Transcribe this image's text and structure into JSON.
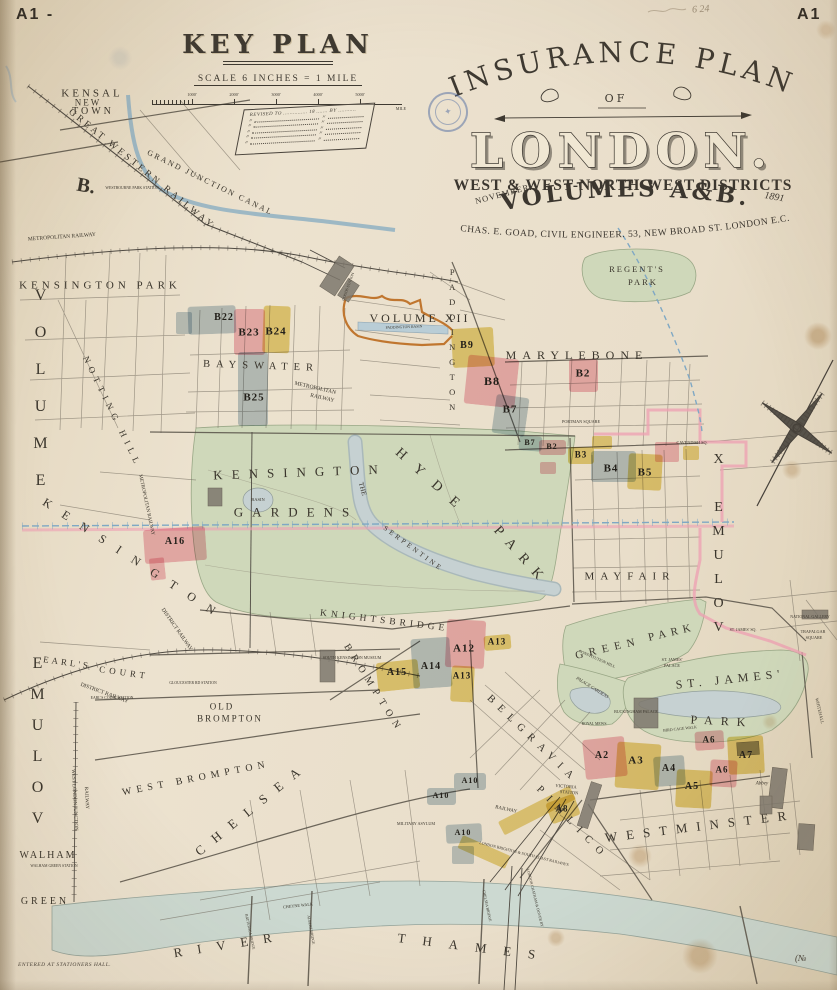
{
  "page": {
    "corner_left": "A1 -",
    "corner_right": "A1",
    "pencil_note": "6 24"
  },
  "key_plan": {
    "title": "KEY PLAN",
    "scale_label": "SCALE  6 INCHES = 1 MILE",
    "scale_ticks": [
      "1000'",
      "2000'",
      "3000'",
      "4000'",
      "5000'"
    ],
    "scale_end": "MILE",
    "revised_header": "REVISED TO ............... 18 ....... BY ...........",
    "revised_rows": [
      "〃",
      "〃",
      "〃",
      "〃",
      "〃"
    ]
  },
  "title_block": {
    "arc": "INSURANCE PLAN",
    "of": "OF",
    "city": "LONDON.",
    "districts": "WEST & WEST-NORTH-WEST DISTRICTS",
    "month": "NOVEMBER",
    "year": "1891",
    "volumes": "VOLUMES A&B.",
    "credit": "CHAS. E. GOAD, CIVIL ENGINEER. 53, NEW BROAD ST. LONDON E.C."
  },
  "footer": {
    "entered": "ENTERED AT STATIONERS HALL.",
    "number": "(№"
  },
  "map": {
    "palette": {
      "pink": "#f0b0bd",
      "yellow": "#e7d06e",
      "blue": "#b5c7d2"
    },
    "labels": [
      {
        "t": "KENSAL",
        "x": 92,
        "y": 94,
        "fs": 11,
        "ls": 3
      },
      {
        "t": "NEW",
        "x": 88,
        "y": 103,
        "fs": 9,
        "ls": 2
      },
      {
        "t": "TOWN",
        "x": 93,
        "y": 112,
        "fs": 10,
        "ls": 3
      },
      {
        "t": "GREAT WESTERN RAILWAY",
        "x": 141,
        "y": 170,
        "fs": 9.5,
        "ls": 3,
        "r": 39
      },
      {
        "t": "GRAND JUNCTION CANAL",
        "x": 210,
        "y": 183,
        "fs": 8,
        "ls": 2,
        "r": 26
      },
      {
        "t": "METROPOLITAN RAILWAY",
        "x": 62,
        "y": 238,
        "fs": 5.5,
        "r": -4
      },
      {
        "t": "WESTBOURNE PARK STATION",
        "x": 132,
        "y": 189,
        "fs": 3.8
      },
      {
        "t": "KENSINGTON PARK",
        "x": 100,
        "y": 286,
        "fs": 11,
        "ls": 4
      },
      {
        "t": "NOTTING HILL",
        "x": 112,
        "y": 412,
        "fs": 9,
        "ls": 5,
        "r": 64
      },
      {
        "t": "B.",
        "x": 86,
        "y": 186,
        "fs": 20,
        "r": 10,
        "b": true
      },
      {
        "t": "VOLUME",
        "x": 40,
        "y": 398,
        "fs": 16,
        "ls": 20,
        "v": true
      },
      {
        "t": "VOLUME",
        "x": 37,
        "y": 748,
        "fs": 16,
        "ls": 14,
        "v": true,
        "rev": true
      },
      {
        "t": "VOLUME X",
        "x": 718,
        "y": 548,
        "fs": 14,
        "ls": 9,
        "v": true,
        "rev": true
      },
      {
        "t": "BAYSWATER",
        "x": 261,
        "y": 367,
        "fs": 10.5,
        "ls": 6,
        "r": 2
      },
      {
        "t": "METROPOLITAN",
        "x": 315,
        "y": 389,
        "fs": 5.5,
        "r": 13
      },
      {
        "t": "RAILWAY",
        "x": 322,
        "y": 399,
        "fs": 5.5,
        "r": 13
      },
      {
        "t": "VOLUME XII",
        "x": 420,
        "y": 318,
        "fs": 12,
        "ls": 3
      },
      {
        "t": "PADDINGTON BASIN",
        "x": 404,
        "y": 328,
        "fs": 3.8,
        "r": -2
      },
      {
        "t": "GOODS STATION",
        "x": 349,
        "y": 287,
        "fs": 3.8,
        "r": -70
      },
      {
        "t": "PADDINGTON",
        "x": 452,
        "y": 342,
        "fs": 8.5,
        "ls": 5,
        "v": true
      },
      {
        "t": "MARYLEBONE",
        "x": 577,
        "y": 355,
        "fs": 12,
        "ls": 6
      },
      {
        "t": "PORTMAN SQUARE",
        "x": 581,
        "y": 422,
        "fs": 4.2
      },
      {
        "t": "CAVENDISH SQ.",
        "x": 692,
        "y": 443,
        "fs": 4.2
      },
      {
        "t": "REGENT'S",
        "x": 637,
        "y": 269,
        "fs": 8.5,
        "ls": 2
      },
      {
        "t": "PARK",
        "x": 643,
        "y": 282,
        "fs": 8.5,
        "ls": 2
      },
      {
        "t": "MAYFAIR",
        "x": 630,
        "y": 577,
        "fs": 11,
        "ls": 6
      },
      {
        "t": "KENSINGTON",
        "x": 300,
        "y": 472,
        "fs": 13,
        "ls": 9,
        "r": -2
      },
      {
        "t": "GARDENS",
        "x": 296,
        "y": 512,
        "fs": 13,
        "ls": 9
      },
      {
        "t": "HYDE",
        "x": 432,
        "y": 483,
        "fs": 14,
        "ls": 14,
        "r": 42
      },
      {
        "t": "PARK",
        "x": 521,
        "y": 557,
        "fs": 14,
        "ls": 10,
        "r": 48
      },
      {
        "t": "THE",
        "x": 362,
        "y": 489,
        "fs": 7,
        "r": 75
      },
      {
        "t": "SERPENTINE",
        "x": 413,
        "y": 549,
        "fs": 7,
        "ls": 3,
        "r": 36
      },
      {
        "t": "BASIN",
        "x": 258,
        "y": 500,
        "fs": 4.5
      },
      {
        "t": "KENSINGTON",
        "x": 135,
        "y": 560,
        "fs": 12,
        "ls": 14,
        "r": 33
      },
      {
        "t": "METROPOLITAN RAILWAY",
        "x": 146,
        "y": 505,
        "fs": 5,
        "r": 78
      },
      {
        "t": "KNIGHTSBRIDGE",
        "x": 384,
        "y": 622,
        "fs": 9.5,
        "ls": 4,
        "r": 7
      },
      {
        "t": "SOUTH KENSINGTON MUSEUM",
        "x": 352,
        "y": 658,
        "fs": 4
      },
      {
        "t": "BROMPTON",
        "x": 373,
        "y": 689,
        "fs": 10,
        "ls": 6,
        "r": 58
      },
      {
        "t": "OLD",
        "x": 222,
        "y": 707,
        "fs": 9,
        "ls": 2
      },
      {
        "t": "BROMPTON",
        "x": 230,
        "y": 719,
        "fs": 9,
        "ls": 2
      },
      {
        "t": "WEST BROMPTON",
        "x": 196,
        "y": 779,
        "fs": 10,
        "ls": 5,
        "r": -11
      },
      {
        "t": "EARL'S",
        "x": 67,
        "y": 663,
        "fs": 9,
        "ls": 3,
        "r": 8
      },
      {
        "t": "COURT",
        "x": 124,
        "y": 673,
        "fs": 9,
        "ls": 4,
        "r": 8
      },
      {
        "t": "DISTRICT RAILWAY",
        "x": 176,
        "y": 630,
        "fs": 5.5,
        "r": 55
      },
      {
        "t": "DISTRICT RAILWAY",
        "x": 104,
        "y": 694,
        "fs": 5.5,
        "r": 20
      },
      {
        "t": "EARL'S COURT STATION",
        "x": 112,
        "y": 699,
        "fs": 3.8
      },
      {
        "t": "GLOUCESTER RD STATION",
        "x": 193,
        "y": 684,
        "fs": 3.8
      },
      {
        "t": "CHELSEA",
        "x": 252,
        "y": 808,
        "fs": 13,
        "ls": 12,
        "r": -39
      },
      {
        "t": "WALHAM",
        "x": 48,
        "y": 856,
        "fs": 10,
        "ls": 2
      },
      {
        "t": "WALHAM GREEN STATION",
        "x": 54,
        "y": 867,
        "fs": 3.8
      },
      {
        "t": "GREEN",
        "x": 45,
        "y": 902,
        "fs": 10,
        "ls": 3
      },
      {
        "t": "WEST LONDON JUNCTION",
        "x": 74,
        "y": 800,
        "fs": 5,
        "r": 87
      },
      {
        "t": "RAILWAY",
        "x": 86,
        "y": 798,
        "fs": 5,
        "r": 87
      },
      {
        "t": "BELGRAVIA",
        "x": 532,
        "y": 740,
        "fs": 10.5,
        "ls": 7,
        "r": 44
      },
      {
        "t": "PIMLICO",
        "x": 572,
        "y": 824,
        "fs": 10.5,
        "ls": 8,
        "r": 46
      },
      {
        "t": "VICTORIA",
        "x": 566,
        "y": 787,
        "fs": 4.5,
        "r": 5
      },
      {
        "t": "STATION",
        "x": 569,
        "y": 793,
        "fs": 4.5,
        "r": 5
      },
      {
        "t": "MILITARY ASYLUM",
        "x": 416,
        "y": 824,
        "fs": 4.2
      },
      {
        "t": "RAILWAY",
        "x": 506,
        "y": 810,
        "fs": 5,
        "r": 12
      },
      {
        "t": "LONDON BRIGHTON & SOUTH COAST RAILWAYS",
        "x": 524,
        "y": 854,
        "fs": 4,
        "r": 14
      },
      {
        "t": "LONDON CHATHAM & DOVER RY",
        "x": 534,
        "y": 898,
        "fs": 3.8,
        "r": 76
      },
      {
        "t": "WESTMINSTER",
        "x": 700,
        "y": 826,
        "fs": 13,
        "ls": 9,
        "r": -7
      },
      {
        "t": "Abbey",
        "x": 762,
        "y": 784,
        "fs": 5,
        "i": true
      },
      {
        "t": "GREEN",
        "x": 608,
        "y": 649,
        "fs": 11,
        "ls": 6,
        "r": -13
      },
      {
        "t": "PARK",
        "x": 672,
        "y": 633,
        "fs": 11,
        "ls": 5,
        "r": -13
      },
      {
        "t": "ST. JAMES'",
        "x": 730,
        "y": 679,
        "fs": 12,
        "ls": 5,
        "r": -6
      },
      {
        "t": "PARK",
        "x": 722,
        "y": 721,
        "fs": 12,
        "ls": 8,
        "r": 3
      },
      {
        "t": "ST. JAMES'",
        "x": 672,
        "y": 660,
        "fs": 4.2
      },
      {
        "t": "PALACE",
        "x": 672,
        "y": 666,
        "fs": 4.2
      },
      {
        "t": "BUCKINGHAM PALACE",
        "x": 636,
        "y": 712,
        "fs": 4
      },
      {
        "t": "PALACE GARDENS",
        "x": 592,
        "y": 688,
        "fs": 4.5,
        "r": 32,
        "i": true
      },
      {
        "t": "CONSTITUTION HILL",
        "x": 597,
        "y": 659,
        "fs": 4,
        "r": 24
      },
      {
        "t": "ROYAL MEWS",
        "x": 594,
        "y": 725,
        "fs": 3.8
      },
      {
        "t": "BIRD CAGE WALK",
        "x": 680,
        "y": 729,
        "fs": 4,
        "r": -6
      },
      {
        "t": "ST. JAMES' SQ.",
        "x": 743,
        "y": 630,
        "fs": 4
      },
      {
        "t": "TRAFALGAR",
        "x": 813,
        "y": 632,
        "fs": 4.2
      },
      {
        "t": "SQUARE",
        "x": 814,
        "y": 638,
        "fs": 4.2
      },
      {
        "t": "NATIONAL GALLERY",
        "x": 810,
        "y": 617,
        "fs": 4
      },
      {
        "t": "WHITEHALL",
        "x": 819,
        "y": 711,
        "fs": 4.5,
        "r": 77
      },
      {
        "t": "CHEYNE WALK",
        "x": 298,
        "y": 906,
        "fs": 4.2,
        "r": -6
      },
      {
        "t": "BATTERSEA BRIDGE",
        "x": 249,
        "y": 932,
        "fs": 3.8,
        "r": 78
      },
      {
        "t": "ALBERT BRIDGE",
        "x": 310,
        "y": 930,
        "fs": 3.8,
        "r": 80
      },
      {
        "t": "CHELSEA BRIDGE",
        "x": 486,
        "y": 906,
        "fs": 3.8,
        "r": 78
      },
      {
        "t": "RIVER",
        "x": 230,
        "y": 944,
        "fs": 13,
        "ls": 15,
        "r": -9
      },
      {
        "t": "THAMES",
        "x": 475,
        "y": 947,
        "fs": 13,
        "ls": 17,
        "r": 7
      }
    ],
    "blocks": [
      {
        "t": "B22",
        "c": "blue",
        "x": 188,
        "y": 306,
        "w": 48,
        "h": 28,
        "r": -2,
        "lx": 224,
        "ly": 318,
        "fs": 10
      },
      {
        "t": "B23",
        "c": "pink",
        "x": 234,
        "y": 309,
        "w": 31,
        "h": 46,
        "r": 0,
        "lx": 249,
        "ly": 333,
        "fs": 11
      },
      {
        "t": "B24",
        "c": "yellow",
        "x": 263,
        "y": 306,
        "w": 27,
        "h": 47,
        "r": 2,
        "lx": 276,
        "ly": 332,
        "fs": 11
      },
      {
        "t": "B25",
        "c": "blue",
        "x": 238,
        "y": 352,
        "w": 30,
        "h": 74,
        "r": 0,
        "lx": 254,
        "ly": 398,
        "fs": 11
      },
      {
        "t": "B9",
        "c": "yellow",
        "x": 452,
        "y": 328,
        "w": 42,
        "h": 39,
        "r": -3,
        "lx": 467,
        "ly": 346,
        "fs": 10
      },
      {
        "t": "B8",
        "c": "pink",
        "x": 466,
        "y": 357,
        "w": 51,
        "h": 49,
        "r": 6,
        "lx": 492,
        "ly": 381,
        "fs": 12
      },
      {
        "t": "B7",
        "c": "blue",
        "x": 494,
        "y": 396,
        "w": 33,
        "h": 39,
        "r": 8,
        "lx": 510,
        "ly": 410,
        "fs": 11
      },
      {
        "t": "B7",
        "c": "blue",
        "x": 519,
        "y": 436,
        "w": 23,
        "h": 15,
        "r": 4,
        "lx": 530,
        "ly": 443,
        "fs": 8
      },
      {
        "t": "B2",
        "c": "pink",
        "x": 569,
        "y": 359,
        "w": 29,
        "h": 33,
        "r": 0,
        "lx": 583,
        "ly": 374,
        "fs": 11
      },
      {
        "t": "B2",
        "c": "pink",
        "x": 539,
        "y": 440,
        "w": 27,
        "h": 15,
        "r": 0,
        "lx": 552,
        "ly": 447,
        "fs": 8
      },
      {
        "t": "B3",
        "c": "yellow",
        "x": 568,
        "y": 447,
        "w": 26,
        "h": 17,
        "r": 0,
        "lx": 581,
        "ly": 455,
        "fs": 9
      },
      {
        "t": "B4",
        "c": "blue",
        "x": 591,
        "y": 451,
        "w": 45,
        "h": 31,
        "r": 0,
        "lx": 611,
        "ly": 469,
        "fs": 11
      },
      {
        "t": "B5",
        "c": "yellow",
        "x": 628,
        "y": 454,
        "w": 34,
        "h": 36,
        "r": 3,
        "lx": 645,
        "ly": 473,
        "fs": 11
      },
      {
        "t": "A16",
        "c": "pink",
        "x": 144,
        "y": 528,
        "w": 62,
        "h": 34,
        "r": -4,
        "lx": 175,
        "ly": 542,
        "fs": 10
      },
      {
        "t": "A12",
        "c": "pink",
        "x": 446,
        "y": 620,
        "w": 39,
        "h": 48,
        "r": 3,
        "lx": 464,
        "ly": 649,
        "fs": 11
      },
      {
        "t": "A13",
        "c": "yellow",
        "x": 484,
        "y": 635,
        "w": 27,
        "h": 15,
        "r": -5,
        "lx": 497,
        "ly": 642,
        "fs": 9
      },
      {
        "t": "A13",
        "c": "yellow",
        "x": 451,
        "y": 666,
        "w": 23,
        "h": 36,
        "r": 3,
        "lx": 462,
        "ly": 676,
        "fs": 9
      },
      {
        "t": "A14",
        "c": "blue",
        "x": 412,
        "y": 638,
        "w": 39,
        "h": 50,
        "r": -4,
        "lx": 431,
        "ly": 667,
        "fs": 10
      },
      {
        "t": "A15",
        "c": "yellow",
        "x": 377,
        "y": 661,
        "w": 42,
        "h": 29,
        "r": -6,
        "lx": 397,
        "ly": 673,
        "fs": 10
      },
      {
        "t": "A10",
        "c": "blue",
        "x": 454,
        "y": 773,
        "w": 32,
        "h": 17,
        "r": 0,
        "lx": 470,
        "ly": 781,
        "fs": 8
      },
      {
        "t": "A10",
        "c": "blue",
        "x": 427,
        "y": 788,
        "w": 29,
        "h": 17,
        "r": 0,
        "lx": 441,
        "ly": 796,
        "fs": 8
      },
      {
        "t": "A10",
        "c": "blue",
        "x": 446,
        "y": 824,
        "w": 36,
        "h": 19,
        "r": -3,
        "lx": 463,
        "ly": 833,
        "fs": 8
      },
      {
        "t": "A2",
        "c": "pink",
        "x": 584,
        "y": 738,
        "w": 42,
        "h": 40,
        "r": -6,
        "lx": 602,
        "ly": 756,
        "fs": 10
      },
      {
        "t": "A3",
        "c": "yellow",
        "x": 616,
        "y": 743,
        "w": 44,
        "h": 46,
        "r": 4,
        "lx": 636,
        "ly": 761,
        "fs": 11
      },
      {
        "t": "A4",
        "c": "blue",
        "x": 654,
        "y": 756,
        "w": 31,
        "h": 30,
        "r": -4,
        "lx": 669,
        "ly": 769,
        "fs": 10
      },
      {
        "t": "A5",
        "c": "yellow",
        "x": 676,
        "y": 770,
        "w": 36,
        "h": 38,
        "r": 3,
        "lx": 692,
        "ly": 787,
        "fs": 10
      },
      {
        "t": "A6",
        "c": "pink",
        "x": 695,
        "y": 731,
        "w": 29,
        "h": 19,
        "r": -4,
        "lx": 709,
        "ly": 740,
        "fs": 9
      },
      {
        "t": "A6",
        "c": "pink",
        "x": 710,
        "y": 760,
        "w": 27,
        "h": 27,
        "r": 3,
        "lx": 722,
        "ly": 770,
        "fs": 9
      },
      {
        "t": "A7",
        "c": "yellow",
        "x": 728,
        "y": 736,
        "w": 36,
        "h": 38,
        "r": -3,
        "lx": 746,
        "ly": 756,
        "fs": 10
      },
      {
        "t": "A8",
        "c": "yellow",
        "x": 548,
        "y": 798,
        "w": 30,
        "h": 22,
        "r": -20,
        "lx": 562,
        "ly": 809,
        "fs": 9
      }
    ],
    "patches": [
      {
        "c": "blue",
        "x": 176,
        "y": 312,
        "w": 16,
        "h": 22
      },
      {
        "c": "pink",
        "x": 150,
        "y": 558,
        "w": 15,
        "h": 22,
        "r": -6
      },
      {
        "c": "yellow",
        "x": 497,
        "y": 803,
        "w": 80,
        "h": 15,
        "r": -27
      },
      {
        "c": "yellow",
        "x": 458,
        "y": 845,
        "w": 52,
        "h": 14,
        "r": 24
      },
      {
        "c": "blue",
        "x": 452,
        "y": 846,
        "w": 22,
        "h": 18
      },
      {
        "c": "pink",
        "x": 655,
        "y": 442,
        "w": 24,
        "h": 20
      },
      {
        "c": "yellow",
        "x": 592,
        "y": 436,
        "w": 20,
        "h": 13
      },
      {
        "c": "yellow",
        "x": 683,
        "y": 446,
        "w": 16,
        "h": 14
      },
      {
        "c": "pink",
        "x": 540,
        "y": 462,
        "w": 16,
        "h": 12
      }
    ]
  }
}
